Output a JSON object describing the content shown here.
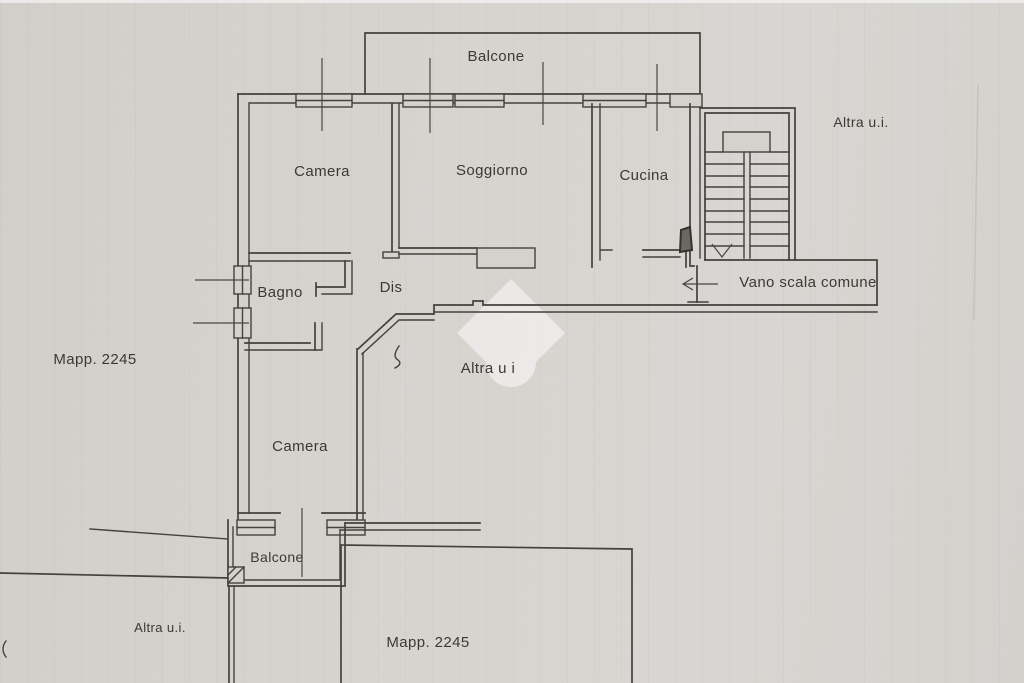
{
  "labels": {
    "balcone_top": "Balcone",
    "camera_top": "Camera",
    "soggiorno": "Soggiorno",
    "cucina": "Cucina",
    "altra_ui_top": "Altra u.i.",
    "bagno": "Bagno",
    "dis": "Dis",
    "vano_scala": "Vano scala comune",
    "mapp_left": "Mapp. 2245",
    "altra_ui_mid": "Altra u i",
    "camera_low": "Camera",
    "balcone_low": "Balcone",
    "altra_ui_bottom": "Altra u.i.",
    "mapp_bottom": "Mapp. 2245"
  },
  "colors": {
    "paper": "#d5d2ce",
    "ink": "#44413d",
    "watermark": "#ffffff"
  }
}
